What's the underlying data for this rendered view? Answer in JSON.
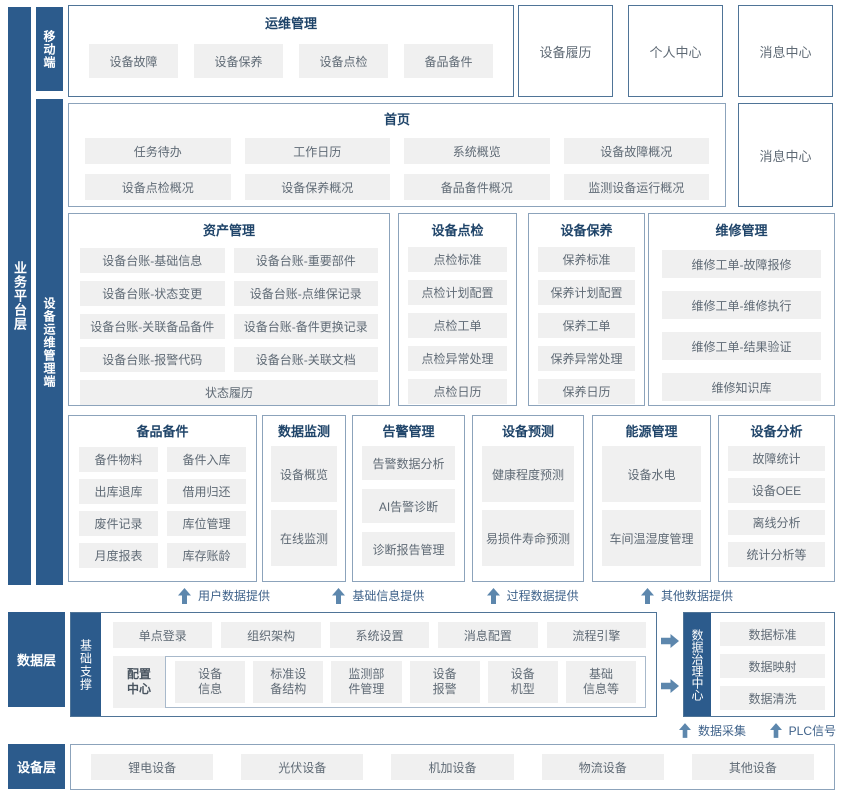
{
  "colors": {
    "bar_bg": "#2C5B8C",
    "box_border": "#557A9E",
    "chip_bg": "#F0F0F0",
    "chip_text": "#5F6A75",
    "title_text": "#1F4469",
    "arrow": "#5D87AD",
    "flow_label": "#3F628A"
  },
  "left_bars": {
    "business_platform": "业务平台层",
    "mobile": "移动端",
    "ops_management": "设备运维管理端",
    "data_layer": "数据层",
    "base_support": "基础支撑",
    "device_layer": "设备层",
    "data_governance": "数据治理中心"
  },
  "mobile_section": {
    "title": "运维管理",
    "items": [
      "设备故障",
      "设备保养",
      "设备点检",
      "备品备件"
    ]
  },
  "top_boxes": [
    "设备履历",
    "个人中心",
    "消息中心"
  ],
  "home_section": {
    "title": "首页",
    "items": [
      "任务待办",
      "工作日历",
      "系统概览",
      "设备故障概况",
      "设备点检概况",
      "设备保养概况",
      "备品备件概况",
      "监测设备运行概况"
    ],
    "side_box": "消息中心"
  },
  "asset_section": {
    "title": "资产管理",
    "items": [
      "设备台账-基础信息",
      "设备台账-重要部件",
      "设备台账-状态变更",
      "设备台账-点维保记录",
      "设备台账-关联备品备件",
      "设备台账-备件更换记录",
      "设备台账-报警代码",
      "设备台账-关联文档"
    ],
    "full_item": "状态履历"
  },
  "inspection_section": {
    "title": "设备点检",
    "items": [
      "点检标准",
      "点检计划配置",
      "点检工单",
      "点检异常处理",
      "点检日历"
    ]
  },
  "upkeep_section": {
    "title": "设备保养",
    "items": [
      "保养标准",
      "保养计划配置",
      "保养工单",
      "保养异常处理",
      "保养日历"
    ]
  },
  "repair_section": {
    "title": "维修管理",
    "items": [
      "维修工单-故障报修",
      "维修工单-维修执行",
      "维修工单-结果验证",
      "维修知识库"
    ]
  },
  "spare_section": {
    "title": "备品备件",
    "items": [
      "备件物料",
      "备件入库",
      "出库退库",
      "借用归还",
      "废件记录",
      "库位管理",
      "月度报表",
      "库存账龄"
    ]
  },
  "monitor_section": {
    "title": "数据监测",
    "items": [
      "设备概览",
      "在线监测"
    ]
  },
  "alarm_section": {
    "title": "告警管理",
    "items": [
      "告警数据分析",
      "AI告警诊断",
      "诊断报告管理"
    ]
  },
  "predict_section": {
    "title": "设备预测",
    "items": [
      "健康程度预测",
      "易损件寿命预测"
    ]
  },
  "energy_section": {
    "title": "能源管理",
    "items": [
      "设备水电",
      "车间温湿度管理"
    ]
  },
  "analysis_section": {
    "title": "设备分析",
    "items": [
      "故障统计",
      "设备OEE",
      "离线分析",
      "统计分析等"
    ]
  },
  "data_flow_labels": [
    "用户数据提供",
    "基础信息提供",
    "过程数据提供",
    "其他数据提供"
  ],
  "support_section": {
    "row1": [
      "单点登录",
      "组织架构",
      "系统设置",
      "消息配置",
      "流程引擎"
    ],
    "config_center": "配置\n中心",
    "row2": [
      "设备\n信息",
      "标准设\n备结构",
      "监测部\n件管理",
      "设备\n报警",
      "设备\n机型",
      "基础\n信息等"
    ]
  },
  "governance_section": {
    "items": [
      "数据标准",
      "数据映射",
      "数据清洗"
    ]
  },
  "bottom_flow_labels": [
    "数据采集",
    "PLC信号"
  ],
  "device_section": {
    "items": [
      "锂电设备",
      "光伏设备",
      "机加设备",
      "物流设备",
      "其他设备"
    ]
  }
}
